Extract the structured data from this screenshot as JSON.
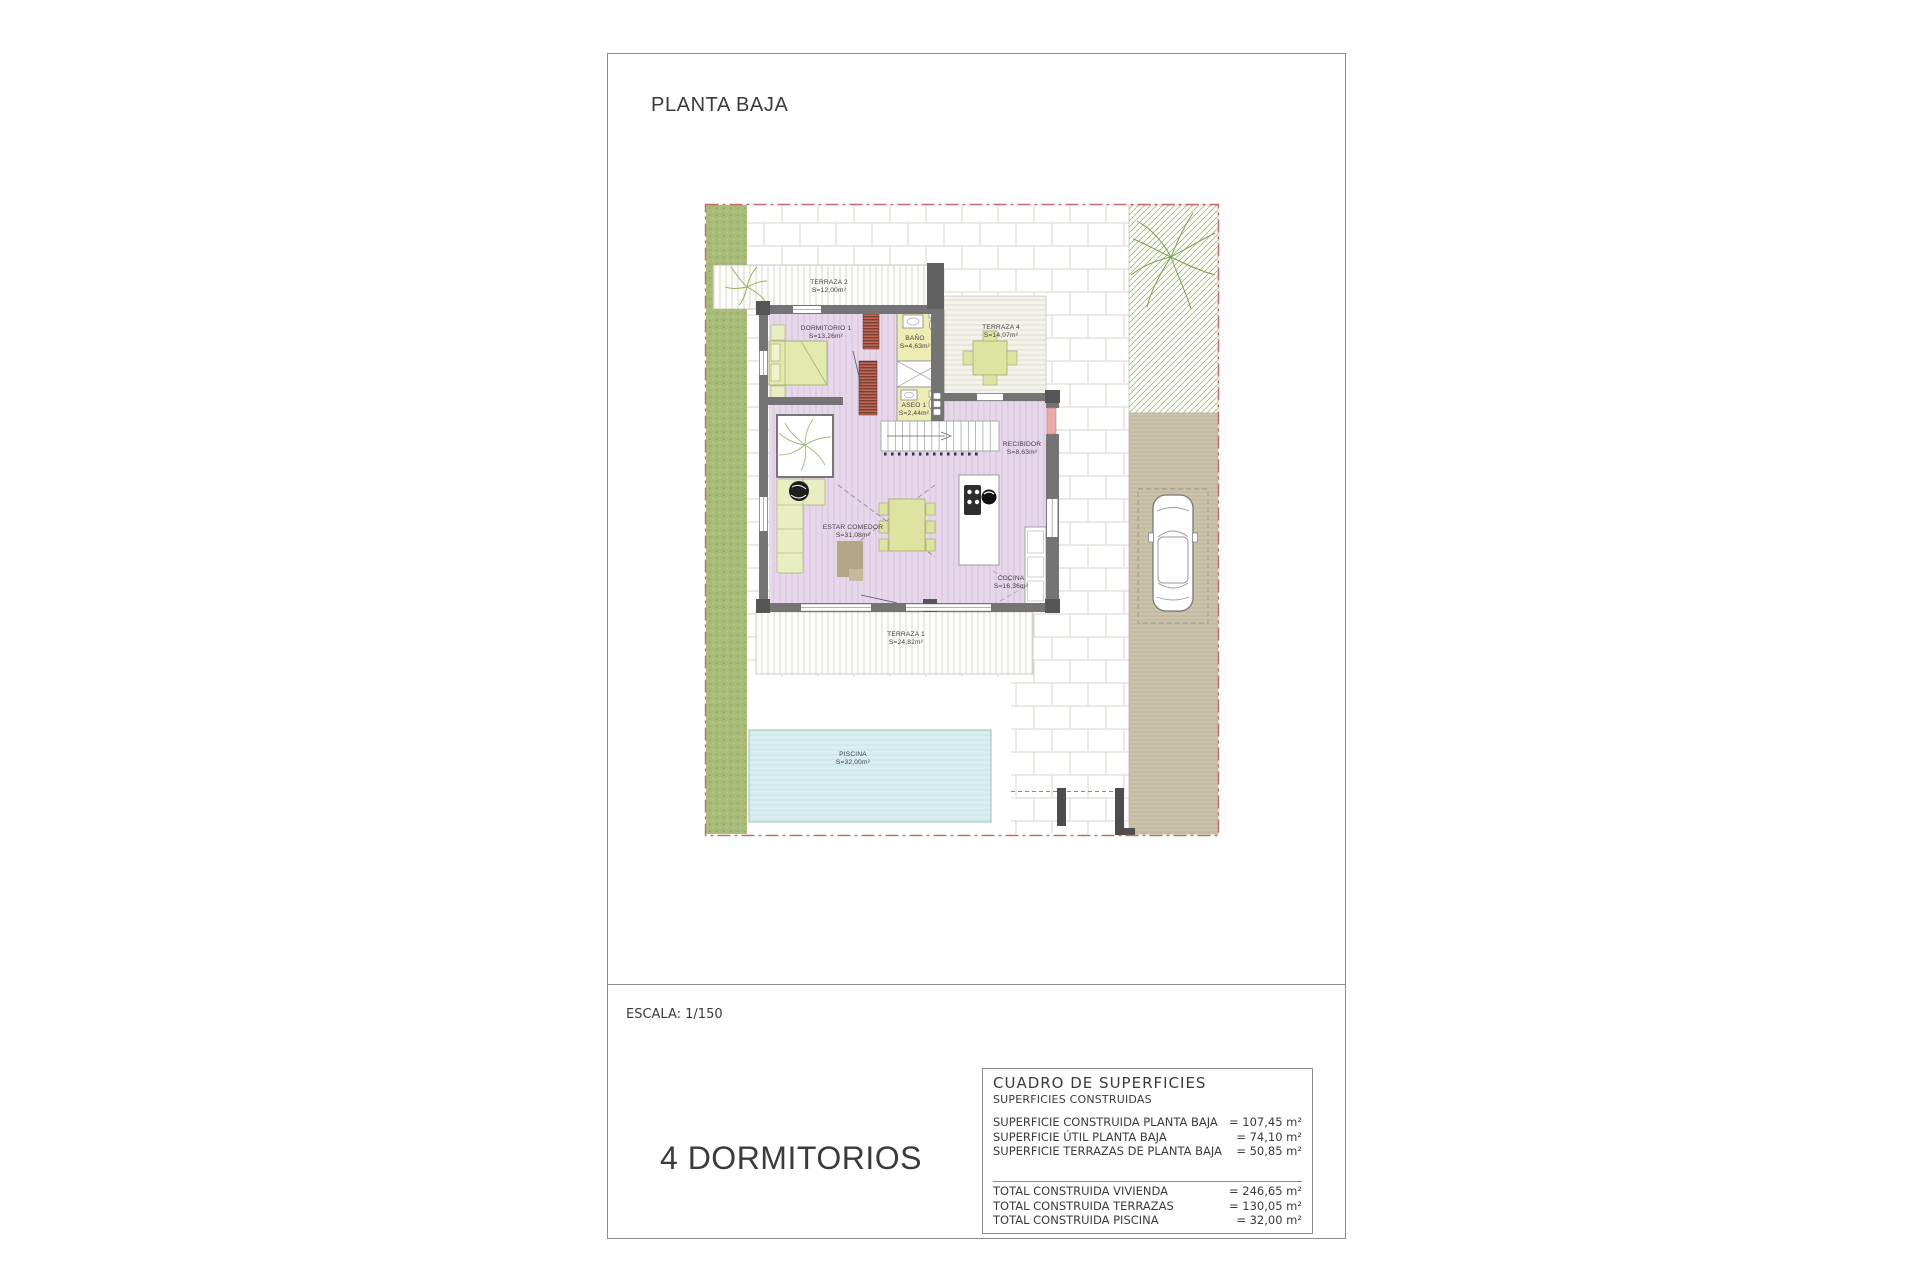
{
  "page": {
    "title": "PLANTA BAJA",
    "scale_label": "ESCALA: 1/150",
    "bedrooms_label": "4 DORMITORIOS"
  },
  "plan": {
    "rooms": [
      {
        "name": "TERRAZA 2",
        "area": "S=12,00m²"
      },
      {
        "name": "DORMITORIO 1",
        "area": "S=13,26m²"
      },
      {
        "name": "BAÑO",
        "area": "S=4,63m²"
      },
      {
        "name": "ASEO 1",
        "area": "S=2,44m²"
      },
      {
        "name": "TERRAZA 4",
        "area": "S=14,07m²"
      },
      {
        "name": "RECIBIDOR",
        "area": "S=8,63m²"
      },
      {
        "name": "ESTAR COMEDOR",
        "area": "S=31,08m²"
      },
      {
        "name": "COCINA",
        "area": "S=16,36m²"
      },
      {
        "name": "TERRAZA 1",
        "area": "S=24,82m²"
      },
      {
        "name": "PISCINA",
        "area": "S=32,00m²"
      }
    ],
    "colors": {
      "boundary_red": "#c46a6a",
      "floor_purple": "#e6d8ea",
      "bath_yellow": "#ececb4",
      "furniture_green": "#dde3a0",
      "grass_green": "#a9bd7a",
      "driveway_tan": "#cbc3ab",
      "pool_blue": "#daeef0",
      "wall_gray": "#747474",
      "door_pink": "#e8a9a9"
    }
  },
  "surface_table": {
    "title": "CUADRO DE SUPERFICIES",
    "subtitle": "SUPERFICIES CONSTRUIDAS",
    "rows": [
      {
        "label": "SUPERFICIE CONSTRUIDA PLANTA BAJA",
        "value": "= 107,45 m²"
      },
      {
        "label": "SUPERFICIE ÚTIL PLANTA BAJA",
        "value": "= 74,10 m²"
      },
      {
        "label": "SUPERFICIE TERRAZAS DE PLANTA BAJA",
        "value": "= 50,85 m²"
      }
    ],
    "totals": [
      {
        "label": "TOTAL CONSTRUIDA VIVIENDA",
        "value": "= 246,65 m²"
      },
      {
        "label": "TOTAL CONSTRUIDA TERRAZAS",
        "value": "= 130,05 m²"
      },
      {
        "label": "TOTAL CONSTRUIDA PISCINA",
        "value": "= 32,00 m²"
      }
    ]
  }
}
